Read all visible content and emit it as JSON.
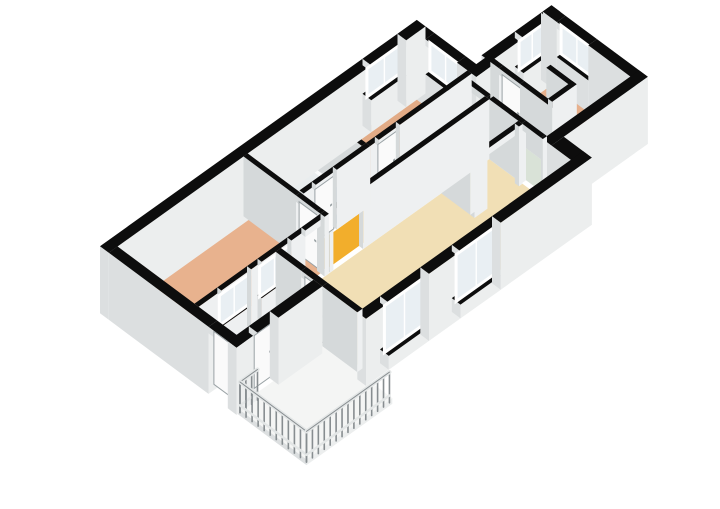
{
  "meta": {
    "type": "floorplan-3d-isometric",
    "background": "#ffffff",
    "canvas": {
      "width": 720,
      "height": 509
    },
    "visible_text": []
  },
  "palette": {
    "wall_top": "#0d0d0d",
    "wall_face_south": "#eef0f1",
    "wall_face_west": "#d5d9da",
    "wall_ext_south": "#eceeee",
    "wall_ext_west": "#dcdfe0",
    "glass": "#e9eff3",
    "frame": "#ffffff",
    "door_leaf": "#fafafa",
    "door_edge": "#9aa2a5",
    "floor_white": "#f1f2f1",
    "balcony_slab": "#f4f5f4",
    "railing_post": "#878d90",
    "railing_rail": "#e3e6e6",
    "fixture": "#fbfcfc",
    "fixture_edge": "#c2c8ca"
  },
  "projection": {
    "origin": [
      100,
      306
    ],
    "ux": 35,
    "uy": -25,
    "vx": 35,
    "vy": 26,
    "hz": 26,
    "wall_height": 2.3,
    "door_height": 2.05,
    "base_depth": 0.28
  },
  "rooms": [
    {
      "id": "bedroom-1",
      "name": "bedroom (west, large)",
      "color": "#e8b28e",
      "rect": [
        0.25,
        0.25,
        3.97,
        2.45
      ]
    },
    {
      "id": "bathroom",
      "name": "bathroom",
      "color": "#a9c3dd",
      "rect": [
        4.0,
        0.25,
        5.78,
        1.7
      ]
    },
    {
      "id": "bedroom-3",
      "name": "small room (top)",
      "color": "#e2ab86",
      "color2": "#e8b28e",
      "rect": [
        5.9,
        0.25,
        8.8,
        1.7
      ]
    },
    {
      "id": "hallway",
      "name": "hallway",
      "color": "#f2ae2c",
      "rect": [
        4.0,
        1.82,
        8.55,
        2.45
      ]
    },
    {
      "id": "closet",
      "name": "closet",
      "color": "#f1f2f1",
      "rect": [
        7.3,
        2.57,
        8.55,
        3.4
      ]
    },
    {
      "id": "storage-strip",
      "name": "storage / pantry",
      "color": "#d9e2d7",
      "rect": [
        8.67,
        1.85,
        9.3,
        4.1
      ]
    },
    {
      "id": "bedroom-2",
      "name": "bedroom (east)",
      "color": "#e6b08d",
      "rect": [
        9.42,
        1.85,
        11.05,
        4.1
      ]
    },
    {
      "id": "living-room",
      "name": "living room",
      "color": "#f1dfb5",
      "rect": [
        2.6,
        2.57,
        8.55,
        4.9
      ]
    },
    {
      "id": "entry",
      "name": "entry / storage room",
      "color": "#f0f1f0",
      "rect": [
        0.25,
        2.57,
        2.45,
        3.65
      ]
    }
  ],
  "balcony": {
    "id": "balcony",
    "name": "balcony",
    "rect": [
      0.0,
      3.9,
      2.45,
      5.9
    ],
    "slab_thickness": 0.22,
    "railing_height": 0.98,
    "post_spacing": 0.17,
    "sides": [
      {
        "name": "north-return",
        "from": [
          0.05,
          3.95
        ],
        "to": [
          0.55,
          3.95
        ]
      },
      {
        "name": "west",
        "from": [
          0.05,
          3.95
        ],
        "to": [
          0.05,
          5.85
        ]
      },
      {
        "name": "south",
        "from": [
          0.05,
          5.85
        ],
        "to": [
          2.42,
          5.85
        ]
      }
    ]
  },
  "walls": [
    {
      "id": "ext-north",
      "rect": [
        0.0,
        0.0,
        9.05,
        0.25
      ],
      "ext": true,
      "windows": [
        {
          "a": 7.5,
          "b": 8.5,
          "z0": 0.95,
          "z1": 2.05
        }
      ]
    },
    {
      "id": "ext-west",
      "rect": [
        0.0,
        0.25,
        0.25,
        3.9
      ],
      "ext": true,
      "doors": [
        {
          "a": 3.1,
          "b": 3.7,
          "leaf": true
        }
      ]
    },
    {
      "id": "ext-toproom-east",
      "rect": [
        8.8,
        0.25,
        9.05,
        1.95
      ],
      "ext": true,
      "windows": [
        {
          "a": 0.5,
          "b": 1.4,
          "z0": 0.95,
          "z1": 2.05
        }
      ]
    },
    {
      "id": "ext-notch",
      "rect": [
        8.8,
        1.7,
        9.42,
        1.95
      ],
      "ext": true
    },
    {
      "id": "ext-bed2-north",
      "rect": [
        9.3,
        1.6,
        11.3,
        1.85
      ],
      "ext": true,
      "windows": [
        {
          "a": 10.25,
          "b": 11.0,
          "z0": 0.95,
          "z1": 2.05
        }
      ]
    },
    {
      "id": "ext-bed2-east",
      "rect": [
        11.05,
        1.6,
        11.3,
        4.35
      ],
      "ext": true,
      "windows": [
        {
          "a": 2.0,
          "b": 2.9,
          "z0": 0.95,
          "z1": 2.05
        }
      ]
    },
    {
      "id": "ext-south-east",
      "rect": [
        8.55,
        4.1,
        11.3,
        4.35
      ],
      "ext": true
    },
    {
      "id": "ext-se-fill",
      "rect": [
        8.55,
        4.35,
        8.9,
        5.15
      ],
      "ext": true
    },
    {
      "id": "ext-living-south",
      "rect": [
        2.45,
        4.9,
        8.9,
        5.15
      ],
      "ext": true,
      "windows": [
        {
          "a": 3.1,
          "b": 4.25,
          "z0": 0.25,
          "z1": 2.05
        },
        {
          "a": 5.15,
          "b": 6.3,
          "z0": 0.25,
          "z1": 2.05
        }
      ]
    },
    {
      "id": "ext-living-west",
      "rect": [
        2.45,
        2.57,
        2.6,
        4.9
      ],
      "doors": [
        {
          "a": 3.3,
          "b": 3.9,
          "leaf": true
        }
      ]
    },
    {
      "id": "ext-entry-south",
      "rect": [
        0.0,
        3.65,
        2.45,
        3.9
      ],
      "ext": true,
      "doors": [
        {
          "a": 0.6,
          "b": 1.2,
          "leaf": true
        }
      ]
    },
    {
      "id": "int-bed1-south",
      "rect": [
        0.25,
        2.45,
        3.97,
        2.57
      ],
      "windows": [
        {
          "a": 0.9,
          "b": 1.75,
          "z0": 0.9,
          "z1": 2.05
        },
        {
          "a": 2.05,
          "b": 2.9,
          "z0": 0.9,
          "z1": 2.05
        }
      ],
      "doors": [
        {
          "a": 3.3,
          "b": 3.85,
          "leaf": false
        }
      ]
    },
    {
      "id": "int-bed1-east",
      "rect": [
        3.85,
        0.25,
        3.97,
        2.45
      ],
      "doors": [
        {
          "a": 1.75,
          "b": 2.35,
          "leaf": true
        }
      ]
    },
    {
      "id": "int-bath-south",
      "rect": [
        4.0,
        1.7,
        5.9,
        1.82
      ],
      "doors": [
        {
          "a": 4.35,
          "b": 4.95,
          "leaf": true
        }
      ]
    },
    {
      "id": "int-bath-east",
      "rect": [
        5.78,
        0.25,
        5.9,
        1.7
      ]
    },
    {
      "id": "int-toproom-south",
      "rect": [
        5.9,
        1.7,
        8.8,
        1.82
      ],
      "doors": [
        {
          "a": 6.15,
          "b": 6.75,
          "leaf": true
        }
      ]
    },
    {
      "id": "int-hall-living",
      "rect": [
        4.0,
        2.45,
        8.55,
        2.57
      ],
      "doors": [
        {
          "a": 4.1,
          "b": 4.95,
          "leaf": false
        }
      ]
    },
    {
      "id": "int-closet-west",
      "rect": [
        7.18,
        2.57,
        7.3,
        3.4
      ]
    },
    {
      "id": "int-closet-south",
      "rect": [
        7.18,
        3.4,
        8.55,
        3.52
      ],
      "doors": [
        {
          "a": 7.55,
          "b": 8.45,
          "leaf": false
        }
      ]
    },
    {
      "id": "int-hall-east",
      "rect": [
        8.55,
        1.82,
        8.67,
        2.57
      ],
      "doors": [
        {
          "a": 1.95,
          "b": 2.5,
          "leaf": false
        }
      ]
    },
    {
      "id": "int-living-east",
      "rect": [
        8.55,
        2.57,
        8.67,
        4.1
      ],
      "doors": [
        {
          "a": 3.5,
          "b": 4.05,
          "leaf": false
        }
      ]
    },
    {
      "id": "int-bed2-west",
      "rect": [
        9.3,
        1.85,
        9.42,
        4.1
      ],
      "doors": [
        {
          "a": 2.1,
          "b": 2.7,
          "leaf": true
        }
      ]
    },
    {
      "id": "int-bed2-stub-v",
      "rect": [
        10.0,
        2.75,
        10.12,
        3.5
      ]
    },
    {
      "id": "int-bed2-stub-h",
      "rect": [
        9.42,
        3.38,
        10.12,
        3.5
      ]
    }
  ],
  "fixtures": [
    {
      "id": "bathtub",
      "name": "bathtub",
      "rect": [
        4.12,
        0.3,
        5.55,
        1.05
      ],
      "h": 0.55
    },
    {
      "id": "washbasin",
      "name": "washbasin",
      "rect": [
        4.02,
        0.75,
        4.38,
        1.12
      ],
      "h": 0.85
    },
    {
      "id": "toilet",
      "name": "toilet",
      "rect": [
        4.02,
        0.3,
        4.32,
        0.62
      ],
      "h": 0.45
    },
    {
      "id": "shower-rail",
      "name": "shower grab rail",
      "from": [
        4.22,
        0.42,
        1.66
      ],
      "to": [
        5.42,
        0.88,
        1.08
      ]
    }
  ]
}
